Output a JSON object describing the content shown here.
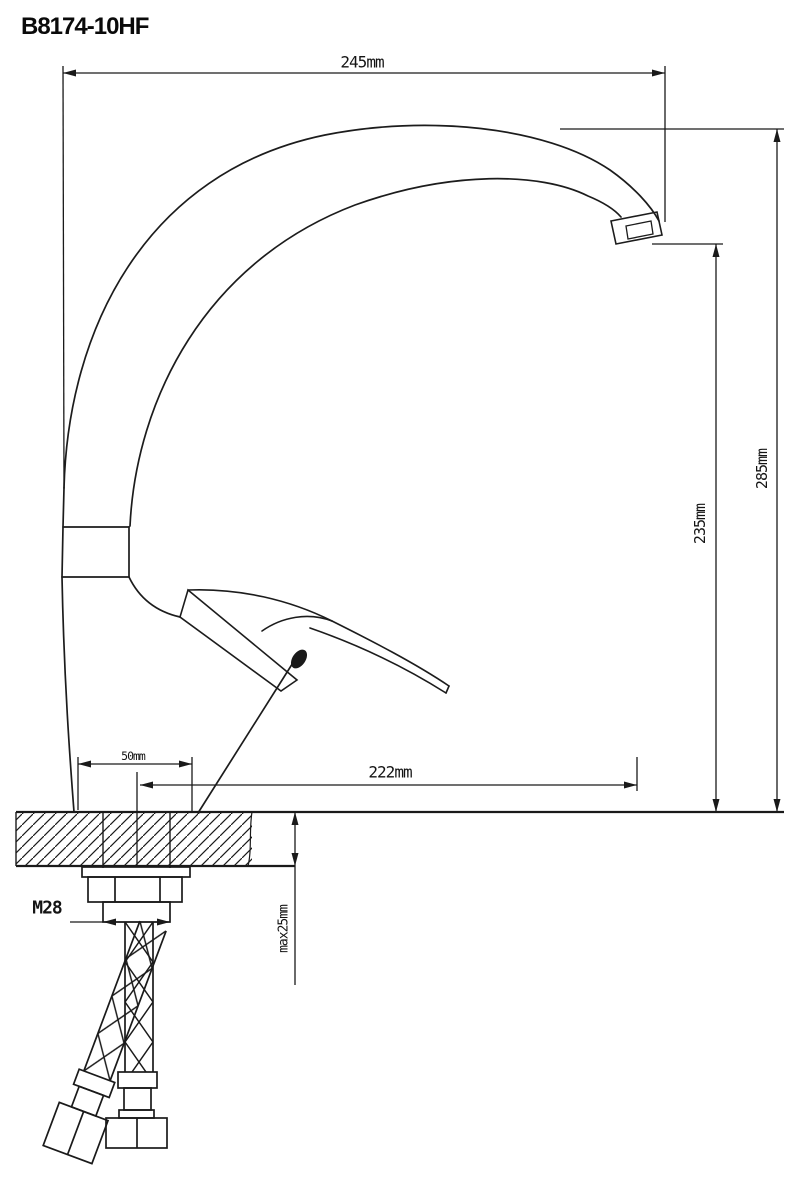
{
  "page": {
    "background_color": "#ffffff",
    "line_color": "#1a1a1a"
  },
  "drawing": {
    "model_number": "B8174-10HF",
    "dimensions": {
      "top_width": "245mm",
      "total_height": "285mm",
      "spout_height": "235mm",
      "reach": "222mm",
      "base": "50mm",
      "thread": "M28",
      "counter_thickness": "max25mm"
    }
  }
}
